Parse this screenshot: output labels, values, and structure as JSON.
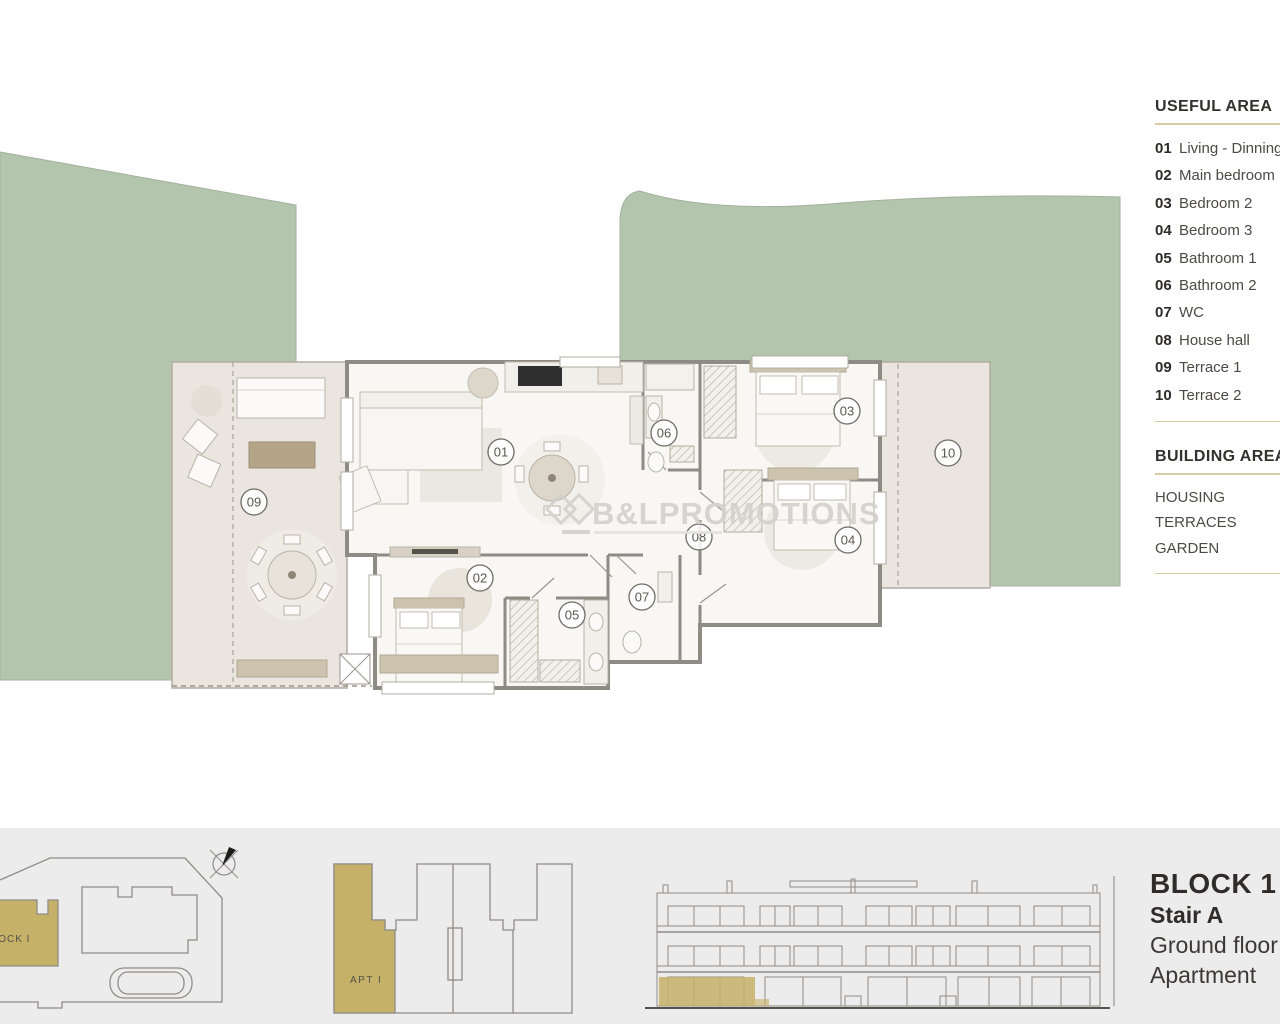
{
  "legend": {
    "useful_area": {
      "title": "USEFUL AREA",
      "items": [
        {
          "num": "01",
          "label": "Living - Dinning"
        },
        {
          "num": "02",
          "label": "Main bedroom"
        },
        {
          "num": "03",
          "label": "Bedroom 2"
        },
        {
          "num": "04",
          "label": "Bedroom 3"
        },
        {
          "num": "05",
          "label": "Bathroom 1"
        },
        {
          "num": "06",
          "label": "Bathroom 2"
        },
        {
          "num": "07",
          "label": "WC"
        },
        {
          "num": "08",
          "label": "House hall"
        },
        {
          "num": "09",
          "label": "Terrace 1"
        },
        {
          "num": "10",
          "label": "Terrace 2"
        }
      ]
    },
    "building_area": {
      "title": "BUILDING AREA",
      "items": [
        "HOUSING",
        "TERRACES",
        "GARDEN"
      ]
    }
  },
  "plan": {
    "rooms": [
      "01",
      "02",
      "03",
      "04",
      "05",
      "06",
      "07",
      "08",
      "09",
      "10"
    ],
    "watermark": "B&LPROMOTIONS"
  },
  "footer": {
    "site_block_label": "BLOCK I",
    "apt_label": "APT I",
    "info_lines": [
      "BLOCK 1",
      "Stair A",
      "Ground floor",
      "Apartment"
    ]
  },
  "colors": {
    "garden_green": "#b4c5ae",
    "terrace_beige": "#eae6df",
    "highlight_gold": "#c5b168",
    "wall_gray": "#8e8b84",
    "rule_tan": "#d9cba6",
    "footer_bg": "#ececec",
    "watermark_gray": "#d4d1cb"
  }
}
